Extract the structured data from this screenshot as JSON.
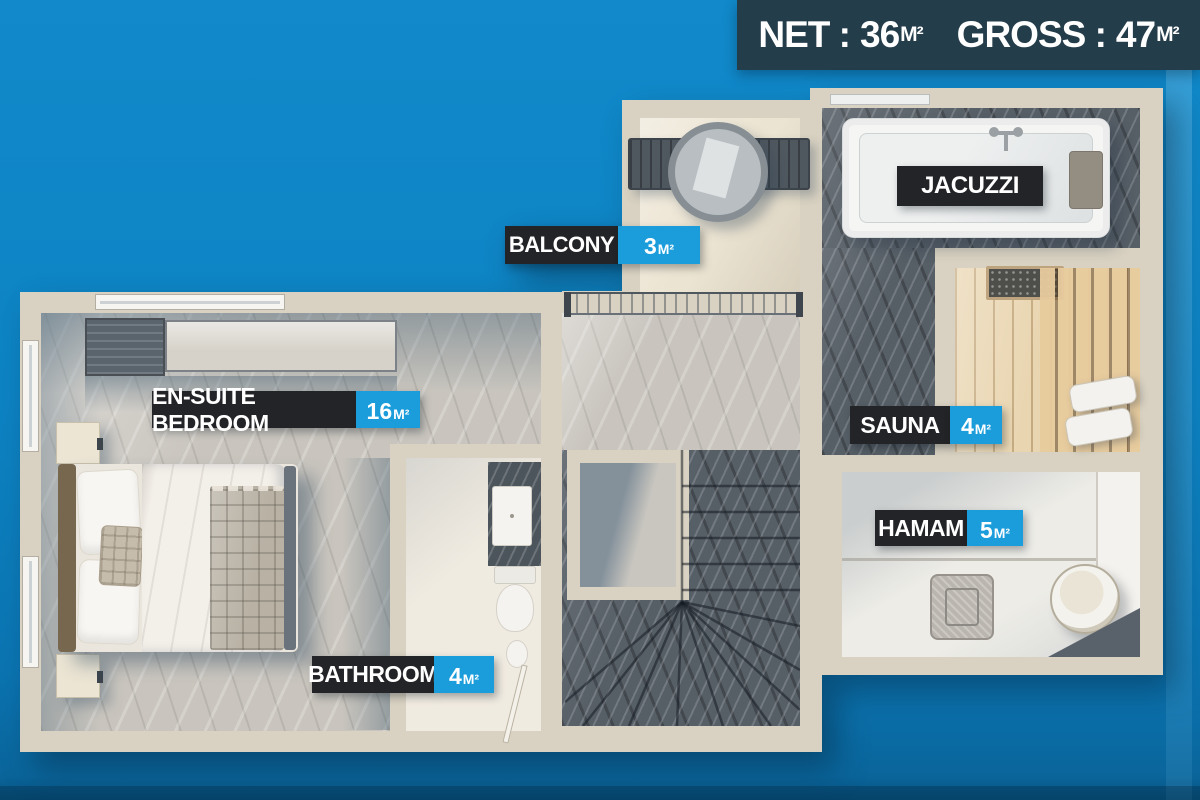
{
  "banner": {
    "net_label": "NET :",
    "net_value": "36",
    "net_unit": "M²",
    "gross_label": "GROSS :",
    "gross_value": "47",
    "gross_unit": "M²"
  },
  "rooms": {
    "bedroom": {
      "name": "EN-SUITE BEDROOM",
      "area_value": "16",
      "area_unit": "M²"
    },
    "bathroom": {
      "name": "BATHROOM",
      "area_value": "4",
      "area_unit": "M²"
    },
    "balcony": {
      "name": "BALCONY",
      "area_value": "3",
      "area_unit": "M²"
    },
    "jacuzzi": {
      "name": "JACUZZI"
    },
    "sauna": {
      "name": "SAUNA",
      "area_value": "4",
      "area_unit": "M²"
    },
    "hamam": {
      "name": "HAMAM",
      "area_value": "5",
      "area_unit": "M²"
    }
  },
  "colors": {
    "background_blue": "#0d82c2",
    "banner_bg": "#243d4b",
    "label_dark": "#232427",
    "area_blue": "#1b9ddb",
    "wall_cream": "#d9d2c2"
  }
}
